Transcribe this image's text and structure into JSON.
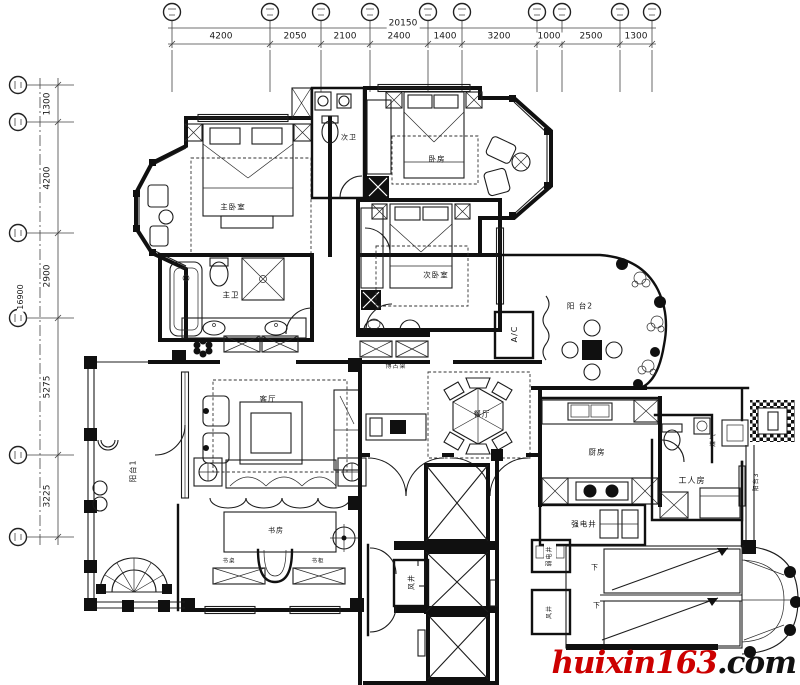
{
  "dimensions": {
    "top": {
      "total": "20150",
      "segments": [
        "4200",
        "2050",
        "2100",
        "2400",
        "1400",
        "3200",
        "1000",
        "2500",
        "1300"
      ]
    },
    "left": {
      "total": "16900",
      "segments": [
        "1300",
        "4200",
        "2900",
        "5275",
        "3225"
      ]
    }
  },
  "plan_labels": [
    {
      "id": "master-bedroom",
      "text": "主卧室",
      "x": 233,
      "y": 207,
      "fs": 7.5
    },
    {
      "id": "secondary-bath",
      "text": "次卫",
      "x": 349,
      "y": 138,
      "fs": 7
    },
    {
      "id": "bedroom",
      "text": "卧房",
      "x": 437,
      "y": 159,
      "fs": 7.5
    },
    {
      "id": "second-bedroom",
      "text": "次卧室",
      "x": 436,
      "y": 275,
      "fs": 7.5
    },
    {
      "id": "master-bath",
      "text": "主卫",
      "x": 231,
      "y": 295,
      "fs": 7.5
    },
    {
      "id": "display-shelf",
      "text": "博古架",
      "x": 396,
      "y": 367,
      "fs": 6
    },
    {
      "id": "balcony-2",
      "text": "阳 台2",
      "x": 580,
      "y": 306,
      "fs": 7.5
    },
    {
      "id": "ac-closet",
      "text": "A/C",
      "x": 515,
      "y": 334,
      "fs": 8,
      "rot": 1
    },
    {
      "id": "living-room",
      "text": "客厅",
      "x": 268,
      "y": 399,
      "fs": 7.5
    },
    {
      "id": "dining-room",
      "text": "餐厅",
      "x": 482,
      "y": 414,
      "fs": 7.5
    },
    {
      "id": "balcony-1",
      "text": "阳台1",
      "x": 133,
      "y": 471,
      "fs": 7.5,
      "rot": 1
    },
    {
      "id": "kitchen",
      "text": "厨房",
      "x": 597,
      "y": 452,
      "fs": 7.5
    },
    {
      "id": "maid-room",
      "text": "工人房",
      "x": 692,
      "y": 481,
      "fs": 8
    },
    {
      "id": "gas-meter",
      "text": "煤气",
      "x": 714,
      "y": 440,
      "fs": 6,
      "rot": 1
    },
    {
      "id": "balcony-3",
      "text": "阳台3",
      "x": 757,
      "y": 482,
      "fs": 6,
      "rot": 1
    },
    {
      "id": "strong-power-shaft",
      "text": "强电井",
      "x": 584,
      "y": 524,
      "fs": 7.5
    },
    {
      "id": "study",
      "text": "书房",
      "x": 276,
      "y": 531,
      "fs": 7
    },
    {
      "id": "study-desk",
      "text": "书桌",
      "x": 229,
      "y": 562,
      "fs": 5.5
    },
    {
      "id": "bookcase",
      "text": "书柜",
      "x": 318,
      "y": 562,
      "fs": 5.5
    },
    {
      "id": "air-shaft-1",
      "text": "风井",
      "x": 412,
      "y": 582,
      "fs": 7,
      "rot": 1
    },
    {
      "id": "weak-power-shaft",
      "text": "弱电井",
      "x": 550,
      "y": 556,
      "fs": 6,
      "rot": 1
    },
    {
      "id": "air-shaft-2",
      "text": "风井",
      "x": 550,
      "y": 612,
      "fs": 6,
      "rot": 1
    },
    {
      "id": "stairs-down-1",
      "text": "下",
      "x": 595,
      "y": 568,
      "fs": 7
    },
    {
      "id": "stairs-down-2",
      "text": "下",
      "x": 597,
      "y": 606,
      "fs": 7
    }
  ],
  "watermark": {
    "brand": "huixin163",
    "suffix": ".com",
    "brand_color": "#cc0000",
    "suffix_color": "#111111"
  }
}
